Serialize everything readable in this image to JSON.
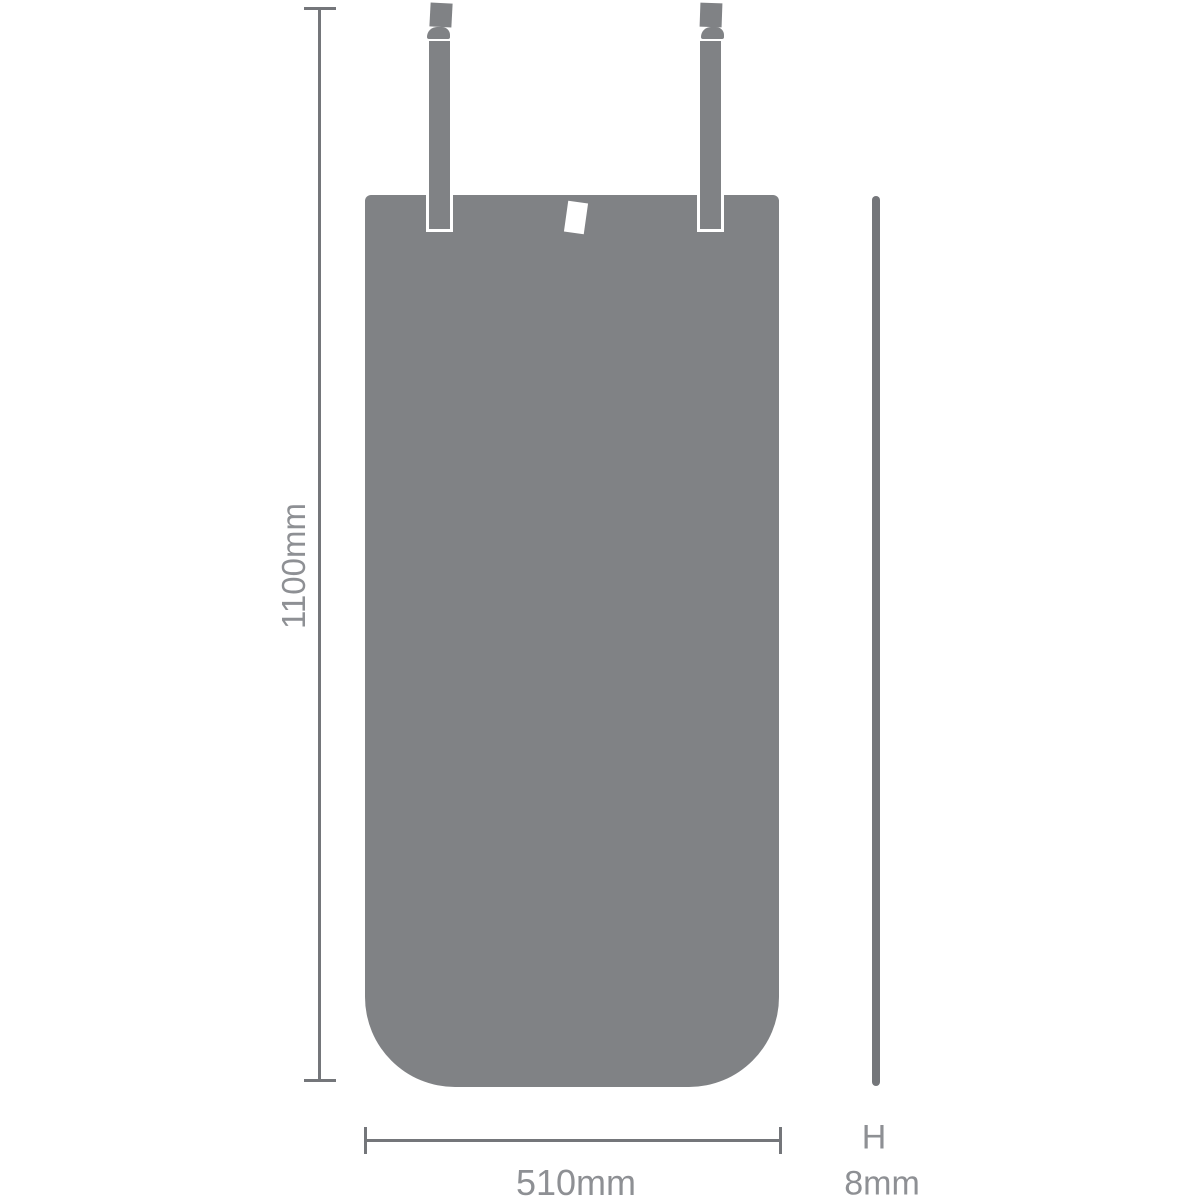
{
  "dimensions": {
    "height": {
      "label": "1100mm"
    },
    "width": {
      "label": "510mm"
    },
    "thickness": {
      "symbol": "H",
      "label": "8mm"
    }
  },
  "colors": {
    "shape_fill": "#808285",
    "dimension_line": "#74767a",
    "label_text": "#8e9094",
    "background": "#ffffff",
    "tag": "#ffffff"
  }
}
